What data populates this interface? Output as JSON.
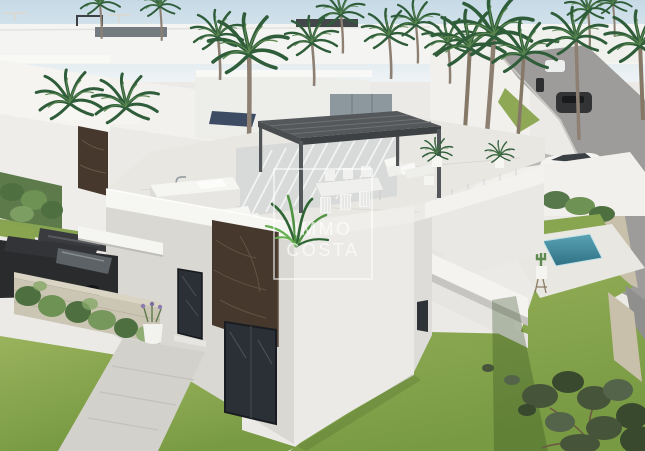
{
  "watermark": {
    "line1": "IMMO",
    "line2": "COSTA"
  },
  "palette": {
    "sky_top": "#c6dae6",
    "sky_bottom": "#eef3f5",
    "wall_bright": "#f6f6f3",
    "wall_light": "#eceae6",
    "wall_shadow": "#d9d8d3",
    "marble": "#46382c",
    "pergola": "#55585a",
    "glass": "#2b3036",
    "grass_light": "#9ab35c",
    "grass_dark": "#789a43",
    "palm_green": "#2f5d3a",
    "palm_light": "#5c8750",
    "olive": "#46543a",
    "pool": "#2f7084",
    "pool_light": "#5ba3b5",
    "road": "#9d9c9a",
    "stone": "#cbc5b4",
    "car_dark": "#2a2b2d",
    "car_white": "#f3f3f1",
    "watermark_white": "rgba(255,255,255,0.68)"
  }
}
